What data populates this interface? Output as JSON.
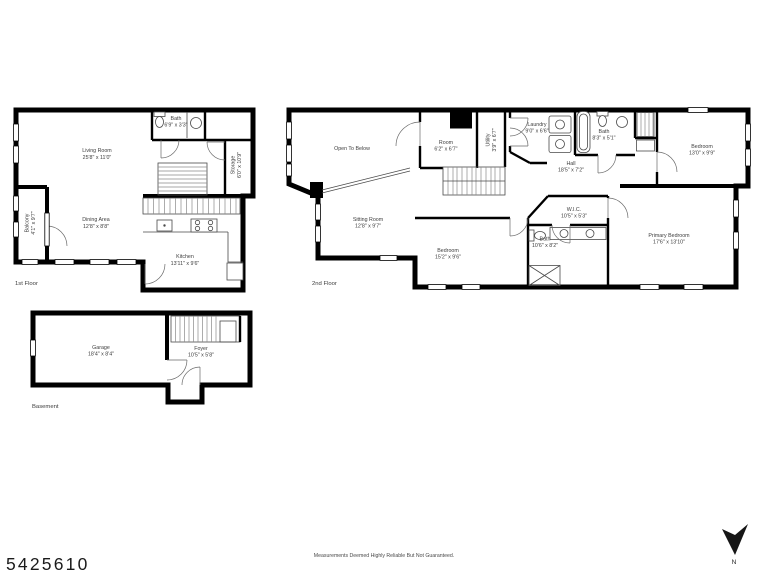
{
  "page": {
    "listing_id": "5425610",
    "disclaimer": "Measurements Deemed Highly Reliable But Not Guaranteed.",
    "compass_label": "N",
    "background": "#ffffff"
  },
  "colors": {
    "wall": "#000000",
    "label_text": "#3d3d3d",
    "fixture_line": "#4a4a4a"
  },
  "floors": [
    {
      "label": "1st Floor",
      "rooms": [
        {
          "name": "Living Room",
          "dims": "25'8\" x 11'0\""
        },
        {
          "name": "Bath",
          "dims": "6'9\" x 3'3\""
        },
        {
          "name": "Storage",
          "dims": "6'0\" x 10'9\""
        },
        {
          "name": "Balcony",
          "dims": "4'1\" x 9'7\""
        },
        {
          "name": "Dining Area",
          "dims": "12'8\" x 8'8\""
        },
        {
          "name": "Kitchen",
          "dims": "13'11\" x 9'6\""
        }
      ]
    },
    {
      "label": "2nd Floor",
      "rooms": [
        {
          "name": "Open To Below",
          "dims": ""
        },
        {
          "name": "Room",
          "dims": "6'2\" x 6'7\""
        },
        {
          "name": "Utility",
          "dims": "3'9\" x 6'7\""
        },
        {
          "name": "Laundry",
          "dims": "9'0\" x 6'6\""
        },
        {
          "name": "Bath",
          "dims": "8'3\" x 5'1\""
        },
        {
          "name": "Bedroom",
          "dims": "13'0\" x 9'9\""
        },
        {
          "name": "Hall",
          "dims": "18'5\" x 7'2\""
        },
        {
          "name": "Sitting Room",
          "dims": "12'8\" x 9'7\""
        },
        {
          "name": "Bedroom",
          "dims": "15'2\" x 9'6\""
        },
        {
          "name": "W.I.C.",
          "dims": "10'5\" x 5'3\""
        },
        {
          "name": "Bath",
          "dims": "10'6\" x 8'2\""
        },
        {
          "name": "Primary Bedroom",
          "dims": "17'6\" x 13'10\""
        }
      ]
    },
    {
      "label": "Basement",
      "rooms": [
        {
          "name": "Garage",
          "dims": "18'4\" x 8'4\""
        },
        {
          "name": "Foyer",
          "dims": "10'5\" x 5'8\""
        }
      ]
    }
  ]
}
